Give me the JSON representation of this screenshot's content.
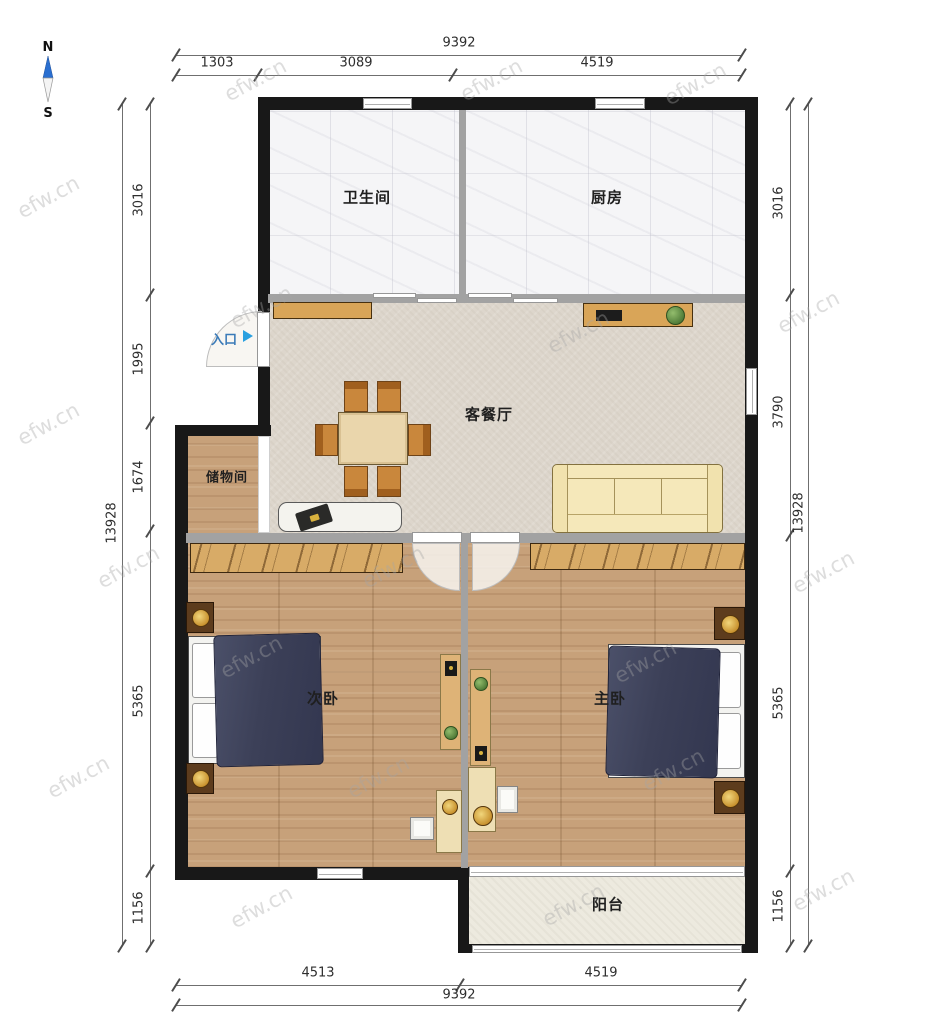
{
  "watermark": {
    "text": "efw.cn"
  },
  "compass": {
    "north": "N",
    "south": "S"
  },
  "entrance": {
    "label": "入口"
  },
  "rooms": {
    "bathroom": "卫生间",
    "kitchen": "厨房",
    "living_dining": "客餐厅",
    "storage": "储物间",
    "secondary_bedroom": "次卧",
    "master_bedroom": "主卧",
    "balcony": "阳台"
  },
  "dimensions": {
    "top": {
      "overall": "9392",
      "segments": [
        "1303",
        "3089",
        "4519"
      ]
    },
    "bottom": {
      "overall": "9392",
      "segments": [
        "4513",
        "4519"
      ]
    },
    "left": {
      "overall": "13928",
      "segments": [
        "3016",
        "1995",
        "1674",
        "5365",
        "1156"
      ]
    },
    "right": {
      "overall": "13928",
      "segments": [
        "3016",
        "3790",
        "5365",
        "1156"
      ]
    }
  },
  "colors": {
    "wall": "#181818",
    "partition": "#a2a2a2",
    "wood_floor": "#c7a17a",
    "living_floor": "#ddd6cc",
    "tile_floor": "#f5f5f7",
    "balcony_floor": "#edeadf",
    "bed_duvet": "#3c4058",
    "sofa": "#f5e8ba",
    "furniture_wood": "#d9a558",
    "entrance_arrow": "#29a0e0",
    "compass_north": "#2a6fd0"
  }
}
